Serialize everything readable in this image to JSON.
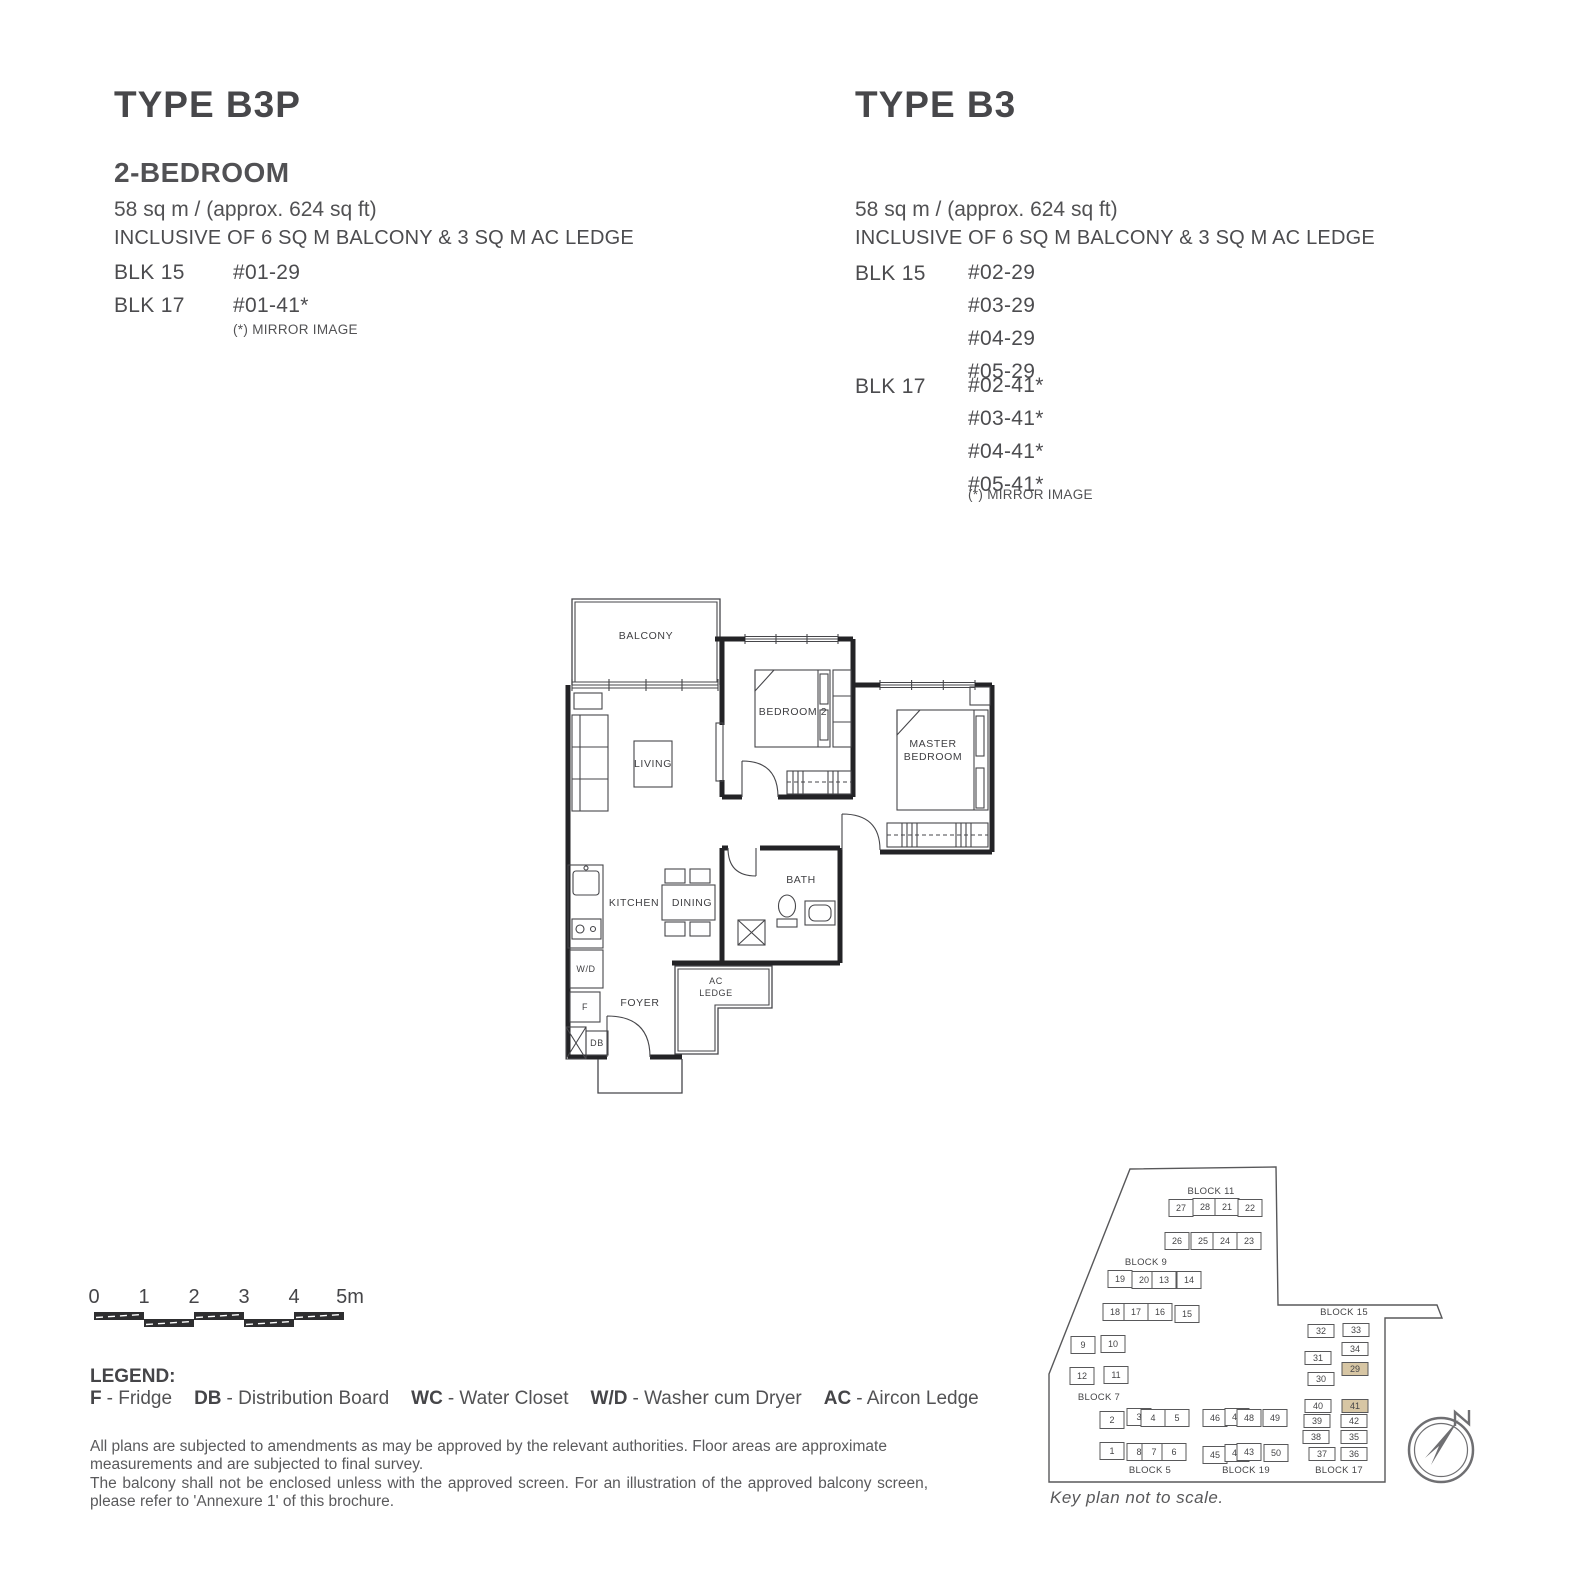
{
  "plans": {
    "b3p": {
      "title": "TYPE B3P",
      "subtitle": "2-BEDROOM",
      "area": "58 sq m / (approx. 624 sq ft)",
      "inclusive": "INCLUSIVE OF 6 SQ M BALCONY & 3 SQ M AC LEDGE",
      "blocks": [
        {
          "name": "BLK 15",
          "units": [
            "#01-29"
          ]
        },
        {
          "name": "BLK 17",
          "units": [
            "#01-41*"
          ]
        }
      ],
      "mirror_note": "(*) MIRROR IMAGE"
    },
    "b3": {
      "title": "TYPE B3",
      "area": "58 sq m / (approx. 624 sq ft)",
      "inclusive": "INCLUSIVE OF 6 SQ M BALCONY & 3 SQ M AC LEDGE",
      "blocks": [
        {
          "name": "BLK 15",
          "units": [
            "#02-29",
            "#03-29",
            "#04-29",
            "#05-29"
          ]
        },
        {
          "name": "BLK 17",
          "units": [
            "#02-41*",
            "#03-41*",
            "#04-41*",
            "#05-41*"
          ]
        }
      ],
      "mirror_note": "(*) MIRROR IMAGE"
    }
  },
  "floorplan": {
    "rooms": {
      "balcony": "BALCONY",
      "living": "LIVING",
      "bedroom2": "BEDROOM 2",
      "master1": "MASTER",
      "master2": "BEDROOM",
      "kitchen": "KITCHEN",
      "dining": "DINING",
      "bath": "BATH",
      "wd": "W/D",
      "fridge": "F",
      "db": "DB",
      "foyer": "FOYER",
      "ac1": "AC",
      "ac2": "LEDGE"
    }
  },
  "scalebar": {
    "labels": [
      "0",
      "1",
      "2",
      "3",
      "4",
      "5m"
    ]
  },
  "legend": {
    "heading": "LEGEND:",
    "items": [
      {
        "abbr": "F",
        "label": "- Fridge"
      },
      {
        "abbr": "DB",
        "label": "- Distribution Board"
      },
      {
        "abbr": "WC",
        "label": "- Water Closet"
      },
      {
        "abbr": "W/D",
        "label": "- Washer cum Dryer"
      },
      {
        "abbr": "AC",
        "label": "- Aircon Ledge"
      }
    ]
  },
  "disclaimer": {
    "para1": "All plans are subjected to amendments as may be approved by the relevant authorities. Floor areas are approximate measurements and are subjected to final survey.",
    "para2": "The balcony shall not be enclosed unless with the approved screen. For an illustration of the approved balcony screen, please refer to 'Annexure 1' of this brochure."
  },
  "keyplan": {
    "note": "Key plan not to scale.",
    "north_label": "N",
    "highlight_color": "#d7c6a4",
    "blocks": [
      {
        "label": "BLOCK 11",
        "lx": 183,
        "ly": 42,
        "units": [
          {
            "n": "27",
            "x": 153,
            "y": 56
          },
          {
            "n": "28",
            "x": 177,
            "y": 55
          },
          {
            "n": "21",
            "x": 199,
            "y": 55
          },
          {
            "n": "22",
            "x": 222,
            "y": 56
          },
          {
            "n": "26",
            "x": 149,
            "y": 89
          },
          {
            "n": "25",
            "x": 175,
            "y": 89
          },
          {
            "n": "24",
            "x": 197,
            "y": 89
          },
          {
            "n": "23",
            "x": 221,
            "y": 89
          }
        ]
      },
      {
        "label": "BLOCK 9",
        "lx": 118,
        "ly": 113,
        "units": [
          {
            "n": "19",
            "x": 92,
            "y": 127
          },
          {
            "n": "20",
            "x": 116,
            "y": 128
          },
          {
            "n": "13",
            "x": 136,
            "y": 128
          },
          {
            "n": "14",
            "x": 161,
            "y": 128
          },
          {
            "n": "18",
            "x": 87,
            "y": 160
          },
          {
            "n": "17",
            "x": 108,
            "y": 160
          },
          {
            "n": "16",
            "x": 132,
            "y": 160
          },
          {
            "n": "15",
            "x": 159,
            "y": 162
          }
        ]
      },
      {
        "label": "BLOCK 7",
        "lx": 71,
        "ly": 248,
        "units": [
          {
            "n": "9",
            "x": 55,
            "y": 193
          },
          {
            "n": "10",
            "x": 85,
            "y": 192
          },
          {
            "n": "12",
            "x": 54,
            "y": 224
          },
          {
            "n": "11",
            "x": 88,
            "y": 223
          }
        ]
      },
      {
        "label": "BLOCK 5",
        "lx": 122,
        "ly": 321,
        "units": [
          {
            "n": "2",
            "x": 84,
            "y": 268
          },
          {
            "n": "3",
            "x": 111,
            "y": 265
          },
          {
            "n": "4",
            "x": 125,
            "y": 266
          },
          {
            "n": "5",
            "x": 149,
            "y": 266
          },
          {
            "n": "1",
            "x": 84,
            "y": 299
          },
          {
            "n": "8",
            "x": 111,
            "y": 300
          },
          {
            "n": "7",
            "x": 126,
            "y": 300
          },
          {
            "n": "6",
            "x": 146,
            "y": 300
          }
        ]
      },
      {
        "label": "BLOCK 19",
        "lx": 218,
        "ly": 321,
        "units": [
          {
            "n": "46",
            "x": 187,
            "y": 266
          },
          {
            "n": "47",
            "x": 209,
            "y": 265
          },
          {
            "n": "48",
            "x": 221,
            "y": 266
          },
          {
            "n": "49",
            "x": 247,
            "y": 266
          },
          {
            "n": "45",
            "x": 187,
            "y": 303
          },
          {
            "n": "44",
            "x": 209,
            "y": 301
          },
          {
            "n": "43",
            "x": 221,
            "y": 300
          },
          {
            "n": "50",
            "x": 248,
            "y": 301
          }
        ]
      },
      {
        "label": "BLOCK 17",
        "lx": 311,
        "ly": 321,
        "uw": 26,
        "uh": 13,
        "units": [
          {
            "n": "40",
            "x": 290,
            "y": 254
          },
          {
            "n": "41",
            "x": 327,
            "y": 254,
            "hl": true
          },
          {
            "n": "39",
            "x": 289,
            "y": 269
          },
          {
            "n": "42",
            "x": 326,
            "y": 269
          },
          {
            "n": "38",
            "x": 288,
            "y": 285
          },
          {
            "n": "35",
            "x": 326,
            "y": 285
          },
          {
            "n": "37",
            "x": 294,
            "y": 302
          },
          {
            "n": "36",
            "x": 326,
            "y": 302
          }
        ]
      },
      {
        "label": "BLOCK 15",
        "lx": 316,
        "ly": 163,
        "uw": 26,
        "uh": 13,
        "units": [
          {
            "n": "32",
            "x": 293,
            "y": 179
          },
          {
            "n": "33",
            "x": 328,
            "y": 178
          },
          {
            "n": "31",
            "x": 290,
            "y": 206
          },
          {
            "n": "34",
            "x": 327,
            "y": 197
          },
          {
            "n": "30",
            "x": 293,
            "y": 227
          },
          {
            "n": "29",
            "x": 327,
            "y": 217,
            "hl": true
          }
        ]
      }
    ]
  }
}
